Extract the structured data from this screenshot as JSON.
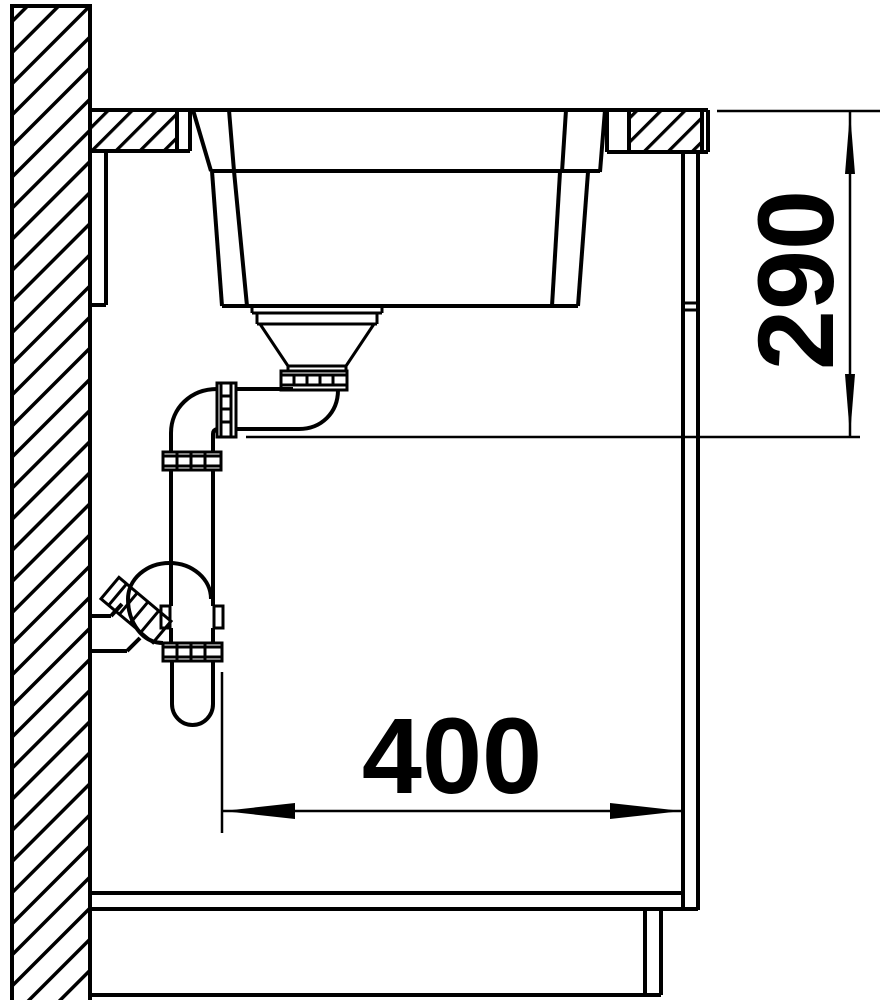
{
  "drawing": {
    "type": "technical-section-drawing",
    "subject": "undermount-sink-with-siphon-in-base-cabinet",
    "background_color": "#ffffff",
    "line_color": "#000000",
    "dimensions": {
      "vertical": {
        "value": "290",
        "orientation": "rotated-90-ccw",
        "position": "right-side"
      },
      "horizontal": {
        "value": "400",
        "orientation": "horizontal",
        "position": "bottom-center"
      }
    },
    "elements": [
      "wall-hatched",
      "countertop-hatched",
      "sink-bowl",
      "strainer-drain",
      "tailpipe-elbow",
      "siphon-trap",
      "wall-outlet",
      "cabinet-side-panel",
      "cabinet-bottom-panel",
      "cabinet-plinth"
    ]
  }
}
